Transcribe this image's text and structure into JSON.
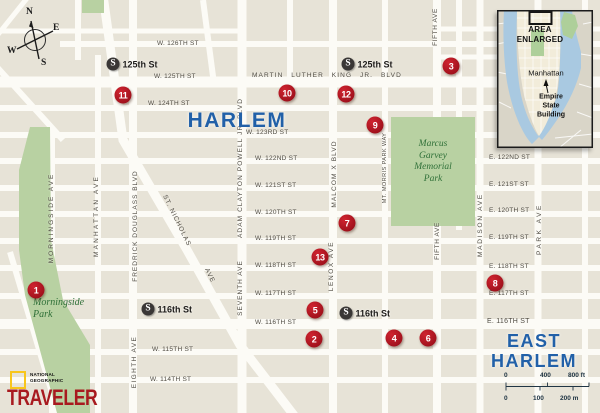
{
  "colors": {
    "block": "#e7e3d7",
    "street": "#fcfbf6",
    "park": "#b8d1a2",
    "water": "#a9c9e1",
    "marker_red": "#ae1220",
    "subway_black": "#3a3736",
    "neighborhood_blue": "#2160a8",
    "street_label": "#4e4a40",
    "park_label_green": "#2f7038",
    "logo_red": "#a81a1f",
    "logo_yellow": "#f8c61c",
    "scale_text": "#203544"
  },
  "compass": {
    "points": [
      "N",
      "E",
      "S",
      "W"
    ]
  },
  "neighborhoods": [
    {
      "text": "HARLEM",
      "x": 237,
      "y": 121,
      "size": 21
    },
    {
      "text": "EAST\nHARLEM",
      "x": 534,
      "y": 351,
      "size": 18
    }
  ],
  "horizontal_streets": [
    {
      "text": "W. 126TH ST",
      "x": 157,
      "y": 41
    },
    {
      "text": "W. 125TH ST",
      "x": 154,
      "y": 74
    },
    {
      "text": "MARTIN LUTHER KING JR. BLVD",
      "x": 252,
      "y": 73,
      "ls": 1.1,
      "ws": 5
    },
    {
      "text": "W. 124TH ST",
      "x": 148,
      "y": 101
    },
    {
      "text": "W. 123RD ST",
      "x": 246,
      "y": 130
    },
    {
      "text": "W. 122ND ST",
      "x": 255,
      "y": 156
    },
    {
      "text": "W. 121ST ST",
      "x": 255,
      "y": 183
    },
    {
      "text": "W. 120TH ST",
      "x": 255,
      "y": 210
    },
    {
      "text": "W. 119TH ST",
      "x": 255,
      "y": 236
    },
    {
      "text": "W. 118TH ST",
      "x": 255,
      "y": 263
    },
    {
      "text": "W. 117TH ST",
      "x": 255,
      "y": 291
    },
    {
      "text": "W. 116TH ST",
      "x": 255,
      "y": 320
    },
    {
      "text": "W. 115TH ST",
      "x": 152,
      "y": 347
    },
    {
      "text": "W. 114TH ST",
      "x": 150,
      "y": 377
    },
    {
      "text": "E. 122ND ST",
      "x": 489,
      "y": 155
    },
    {
      "text": "E. 121ST ST",
      "x": 489,
      "y": 182
    },
    {
      "text": "E. 120TH ST",
      "x": 489,
      "y": 208
    },
    {
      "text": "E. 119TH ST",
      "x": 489,
      "y": 235
    },
    {
      "text": "E. 118TH ST",
      "x": 489,
      "y": 264
    },
    {
      "text": "E. 117TH ST",
      "x": 489,
      "y": 291
    },
    {
      "text": "E. 116TH ST",
      "x": 487,
      "y": 318,
      "size": 7
    }
  ],
  "vertical_streets": [
    {
      "text": "MORNINGSIDE AVE",
      "x": 52,
      "y": 218,
      "ls": 2
    },
    {
      "text": "MANHATTAN AVE",
      "x": 97,
      "y": 216,
      "ls": 2.2
    },
    {
      "text": "FREDRICK DOUGLASS BLVD",
      "x": 136,
      "y": 226,
      "ls": 1
    },
    {
      "text": "EIGHTH AVE",
      "x": 135,
      "y": 362,
      "ls": 1.4
    },
    {
      "text": "ADAM CLAYTON POWELL JR. BLVD",
      "x": 241,
      "y": 168,
      "ls": 1.1
    },
    {
      "text": "SEVENTH AVE",
      "x": 241,
      "y": 288,
      "ls": 1
    },
    {
      "text": "MALCOM X BLVD",
      "x": 335,
      "y": 174,
      "ls": 1.1
    },
    {
      "text": "LENOX AVE",
      "x": 332,
      "y": 266,
      "ls": 1.6
    },
    {
      "text": "MT. MORRIS PARK WAY",
      "x": 386,
      "y": 168,
      "ls": 0.4,
      "size": 5.6
    },
    {
      "text": "FIFTH AVE",
      "x": 436,
      "y": 27,
      "ls": 0.6
    },
    {
      "text": "FIFTH AVE",
      "x": 438,
      "y": 241,
      "ls": 0.6
    },
    {
      "text": "MADISON AVE",
      "x": 481,
      "y": 225,
      "ls": 1.8
    },
    {
      "text": "PARK AVE",
      "x": 540,
      "y": 229,
      "ls": 2.6
    },
    {
      "text": "ST. NICHOLAS",
      "x": 176,
      "y": 221,
      "rot": 64,
      "ls": 1
    },
    {
      "text": "AVE",
      "x": 209,
      "y": 276,
      "rot": 64,
      "ls": 1
    }
  ],
  "markers": [
    {
      "n": "1",
      "x": 36,
      "y": 290
    },
    {
      "n": "2",
      "x": 314,
      "y": 339
    },
    {
      "n": "3",
      "x": 451,
      "y": 66
    },
    {
      "n": "4",
      "x": 394,
      "y": 338
    },
    {
      "n": "5",
      "x": 315,
      "y": 310
    },
    {
      "n": "6",
      "x": 428,
      "y": 338
    },
    {
      "n": "7",
      "x": 347,
      "y": 223
    },
    {
      "n": "8",
      "x": 495,
      "y": 283
    },
    {
      "n": "9",
      "x": 375,
      "y": 125
    },
    {
      "n": "10",
      "x": 287,
      "y": 93
    },
    {
      "n": "11",
      "x": 123,
      "y": 95
    },
    {
      "n": "12",
      "x": 346,
      "y": 94
    },
    {
      "n": "13",
      "x": 320,
      "y": 257
    }
  ],
  "stations": [
    {
      "symbol": "S",
      "label": "125th St",
      "x": 113,
      "y": 64
    },
    {
      "symbol": "S",
      "label": "125th St",
      "x": 348,
      "y": 64
    },
    {
      "symbol": "S",
      "label": "116th St",
      "x": 148,
      "y": 309
    },
    {
      "symbol": "S",
      "label": "116th St",
      "x": 346,
      "y": 313
    }
  ],
  "park_labels": [
    {
      "text": "Morningside\nPark",
      "x": 33,
      "y": 297,
      "size": 10
    },
    {
      "text": "Marcus\nGarvey\nMemorial\nPark",
      "cx": 433,
      "y": 139,
      "size": 9.5
    }
  ],
  "inset": {
    "caption": "AREA\nENLARGED",
    "island_label": "Manhattan",
    "landmark_label": "Empire\nState\nBuilding"
  },
  "scale_bar": {
    "feet": [
      "0",
      "400",
      "800 ft"
    ],
    "meters": [
      "0",
      "100",
      "200 m"
    ]
  },
  "logo": {
    "brand": "NATIONAL\nGEOGRAPHIC",
    "title": "TRAVELER"
  }
}
